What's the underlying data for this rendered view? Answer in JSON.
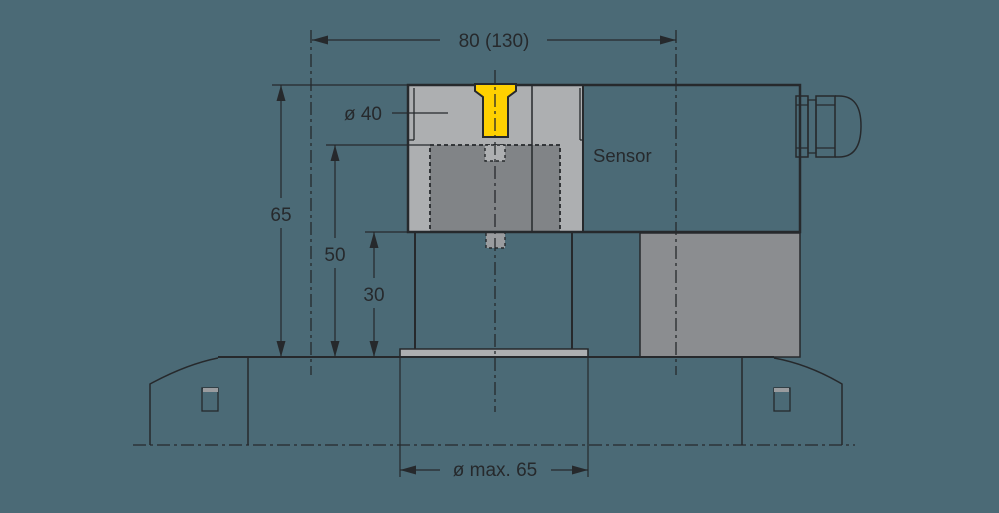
{
  "drawing": {
    "title": "Sensor mounting dimensional drawing",
    "labels": {
      "sensor": "Sensor"
    },
    "dimensions": {
      "top_width": "80 (130)",
      "overall_height": "65",
      "insert_height": "50",
      "column_height": "30",
      "clamp_diameter": "ø 40",
      "max_diameter": "ø max. 65"
    },
    "colors": {
      "background": "#4b6a76",
      "body_gray": "#adafb1",
      "insert_gray": "#818487",
      "block_gray": "#8b8d90",
      "stub_gray": "#9a9c9f",
      "accent_yellow": "#ffd100",
      "line": "#26292c",
      "text": "#26292c"
    }
  }
}
